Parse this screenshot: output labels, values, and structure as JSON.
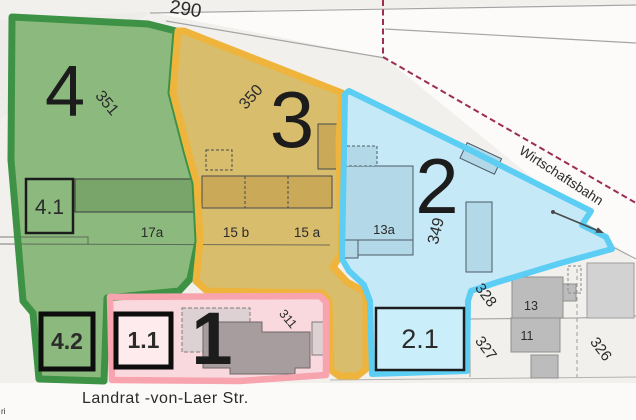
{
  "zones": {
    "green": {
      "number": "4",
      "parcel": "351",
      "fill": "#8cba7e",
      "border": "#3e9245",
      "box_a": "4.1",
      "box_b": "4.2"
    },
    "yellow": {
      "number": "3",
      "parcel": "350",
      "fill": "#d8bd6d",
      "border": "#eeb43c"
    },
    "blue": {
      "number": "2",
      "parcel": "349",
      "fill": "#c6e9f8",
      "border": "#5ccdf3",
      "box_a": "2.1",
      "box_fill": "#cbeefb"
    },
    "pink": {
      "number": "1",
      "parcel": "311",
      "fill": "#f9d9de",
      "border": "#f7a4af",
      "box_a": "1.1",
      "box_fill": "#fdebee"
    }
  },
  "base_map": {
    "streets": {
      "bottom": "Landrat -von-Laer Str.",
      "railway": "Wirtschaftsbahn"
    },
    "parcels": {
      "p290": "290",
      "p328": "328",
      "p327": "327",
      "p326": "326"
    },
    "houses": {
      "h17a": "17a",
      "h15b": "15 b",
      "h15a": "15 a",
      "h13a": "13a",
      "h13": "13",
      "h11": "11"
    },
    "attribution": "ri"
  },
  "colors": {
    "background": "#f2f0ed",
    "corridor_white": "#fcfbfa",
    "street_band": "#fbfaf9",
    "railway_line": "#a5a5a5",
    "parcel_line": "#9b9b9b",
    "boundary_dashed": "#9c2e56",
    "building_gray": "#bcbcbc",
    "building_light_gray": "#d2d2d2",
    "label_dark": "#2b2b2b",
    "street_label": "#4c4c4c"
  }
}
